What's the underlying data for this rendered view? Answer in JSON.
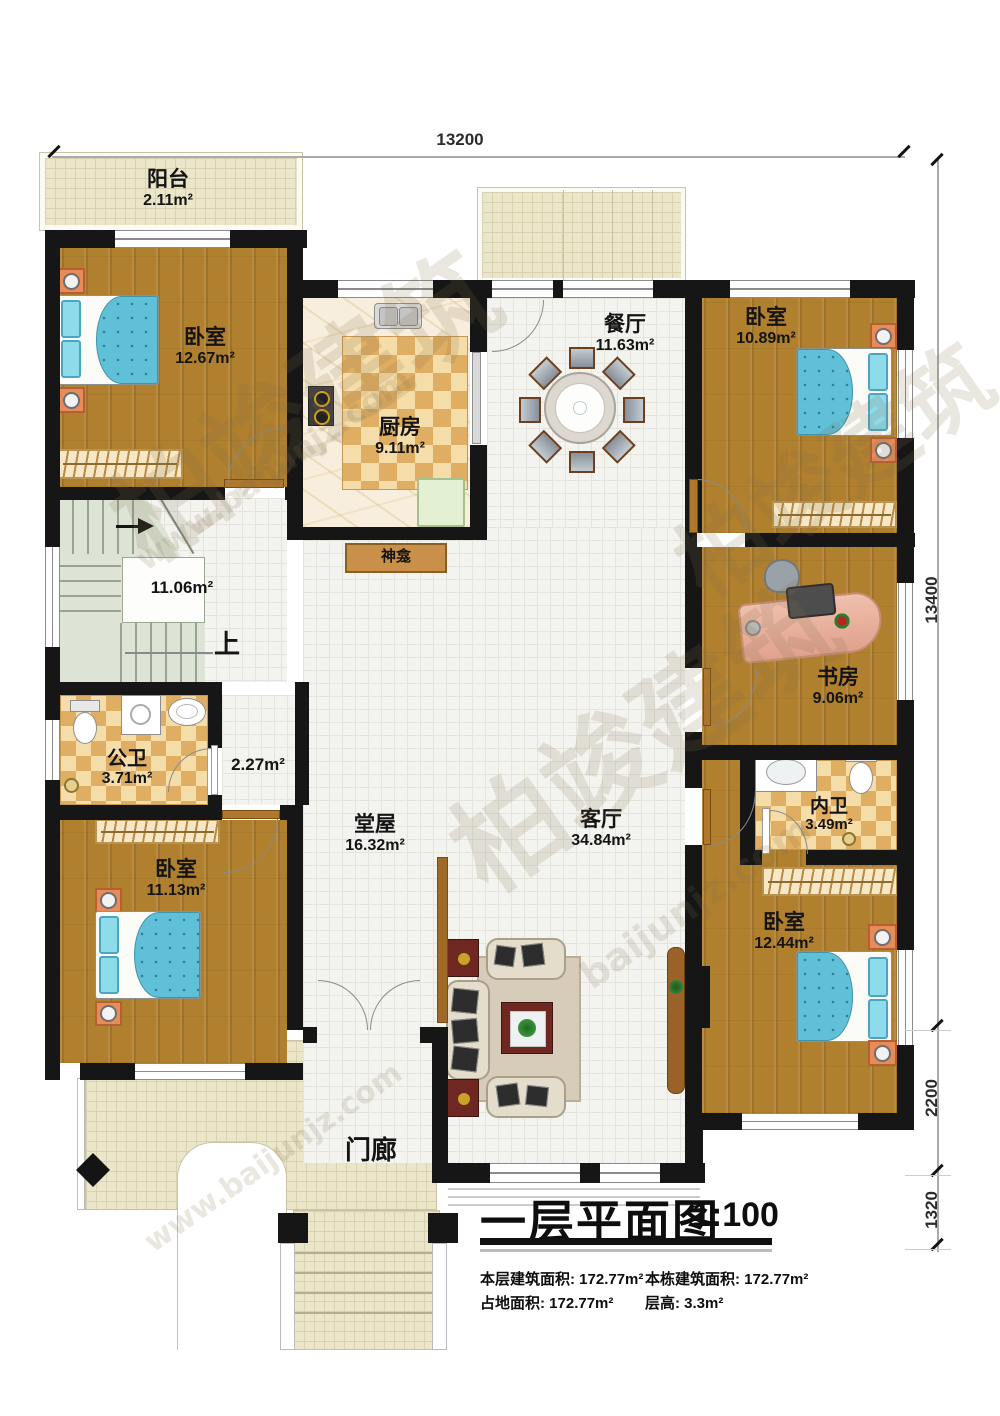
{
  "meta": {
    "type": "floor-plan",
    "floor": "first"
  },
  "dimensions": {
    "top_width": "13200",
    "right_total": "13400",
    "right_mid": "2200",
    "right_bottom": "1320"
  },
  "rooms": {
    "balcony": {
      "name": "阳台",
      "area": "2.11m²"
    },
    "bedroom_tl": {
      "name": "卧室",
      "area": "12.67m²"
    },
    "kitchen": {
      "name": "厨房",
      "area": "9.11m²"
    },
    "dining": {
      "name": "餐厅",
      "area": "11.63m²"
    },
    "bedroom_tr": {
      "name": "卧室",
      "area": "10.89m²"
    },
    "shrine": {
      "name": "神龛"
    },
    "stairs": {
      "area": "11.06m²",
      "up": "上"
    },
    "public_bath": {
      "name": "公卫",
      "area": "3.71m²"
    },
    "corridor": {
      "area": "2.27m²"
    },
    "study": {
      "name": "书房",
      "area": "9.06m²"
    },
    "hall": {
      "name": "堂屋",
      "area": "16.32m²"
    },
    "living": {
      "name": "客厅",
      "area": "34.84m²"
    },
    "inner_bath": {
      "name": "内卫",
      "area": "3.49m²"
    },
    "bedroom_bl": {
      "name": "卧室",
      "area": "11.13m²"
    },
    "bedroom_br": {
      "name": "卧室",
      "area": "12.44m²"
    },
    "porch": {
      "name": "门廊"
    }
  },
  "titleblock": {
    "title": "一层平面图",
    "scale": "1:100",
    "stats": [
      {
        "label": "本层建筑面积:",
        "value": "172.77m²"
      },
      {
        "label": "本栋建筑面积:",
        "value": "172.77m²"
      },
      {
        "label": "占地面积:",
        "value": "172.77m²"
      },
      {
        "label": "层高:",
        "value": "3.3m²"
      }
    ]
  },
  "watermarks": [
    "柏竣建筑",
    "www.baijunjz.com",
    "柏竣建筑",
    "baijunjz.com",
    "柏竣建筑",
    "www.baijunjz.com"
  ],
  "colors": {
    "wall": "#161616",
    "wood_floor": "#b0802e",
    "bed_blue": "#5fc0d8",
    "checker_dark": "#dfae62",
    "checker_light": "#f4dda8",
    "stair_green": "#dde4d6",
    "porch_beige": "#ebe6ca",
    "accent_red": "#6f2721"
  }
}
